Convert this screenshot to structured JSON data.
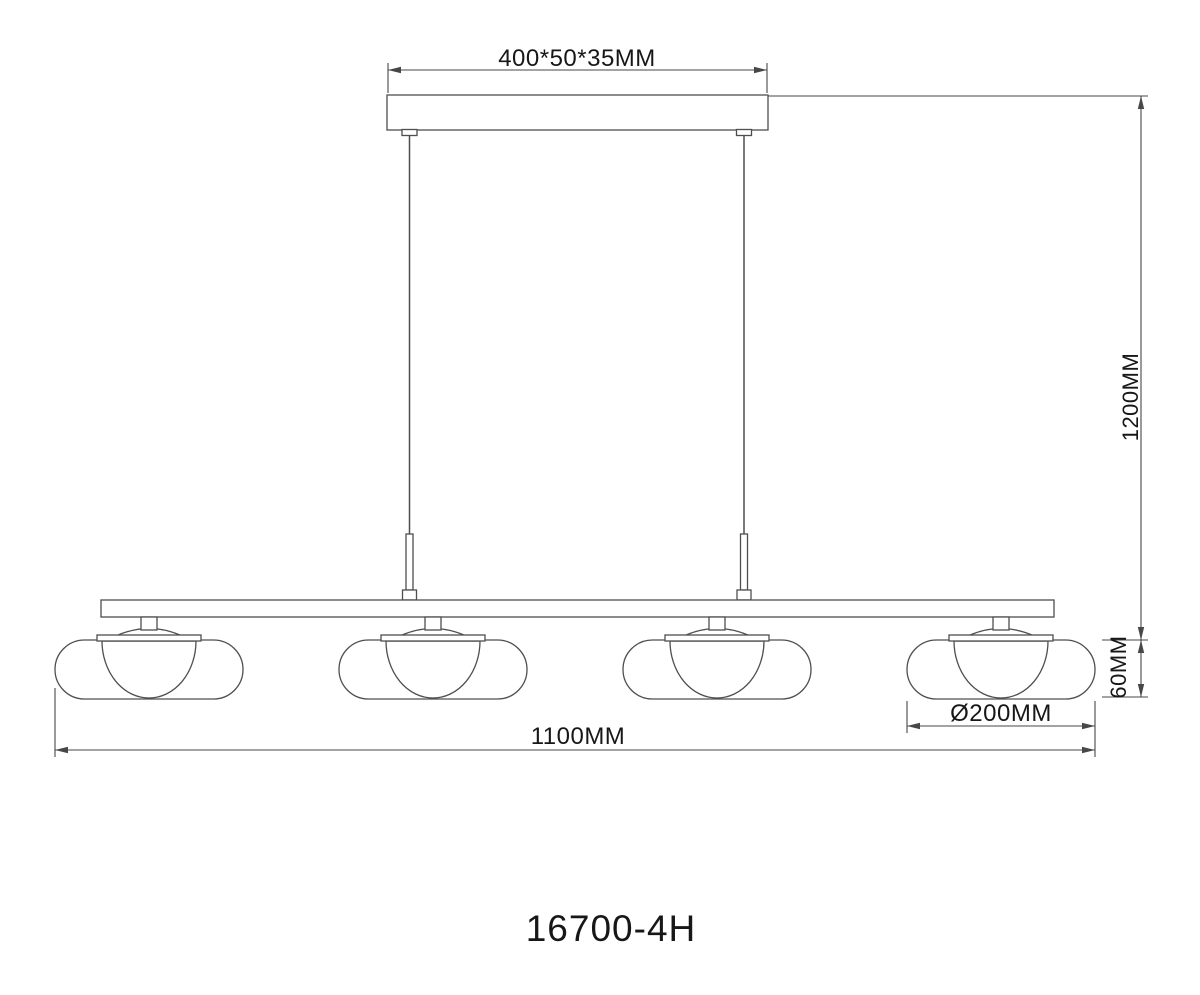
{
  "page": {
    "type": "technical-line-drawing",
    "subject": "linear pendant light fixture"
  },
  "colors": {
    "background": "#ffffff",
    "line": "#4f4f4f",
    "dimension_line": "#474747",
    "text": "#171717"
  },
  "drawing": {
    "model_number": "16700-4H",
    "lamp_count": 4,
    "dimensions": {
      "canopy_size": "400*50*35MM",
      "suspension_drop": "1200MM",
      "shade_height": "60MM",
      "shade_diameter": "Ø200MM",
      "overall_length": "1100MM"
    }
  }
}
